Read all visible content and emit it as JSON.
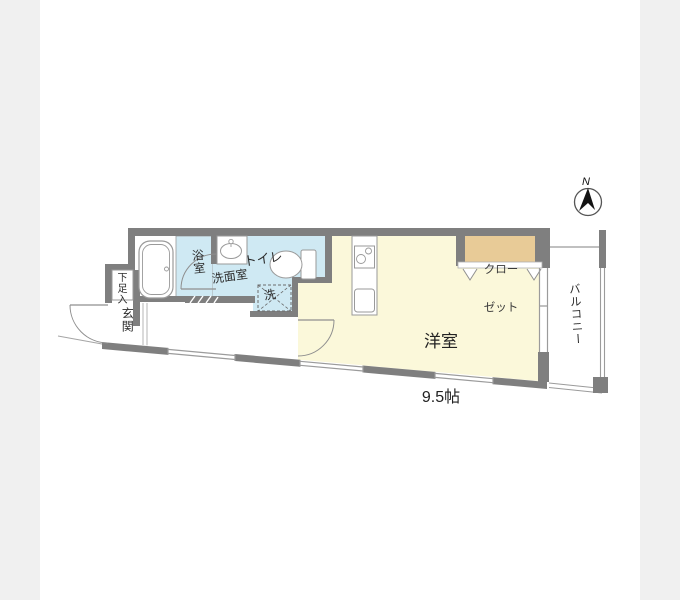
{
  "colors": {
    "wall": "#7f7f7f",
    "wet_area": "#cfe9f3",
    "main_room": "#fbf8da",
    "closet": "#e8cb97",
    "background_strip": "#f0f0f0"
  },
  "floorplan": {
    "compass": {
      "north_label": "N"
    },
    "rooms": {
      "main_room_name": "洋室",
      "main_room_size": "9.5帖",
      "closet_line1": "クロー",
      "closet_line2": "ゼット",
      "balcony": "バルコニー",
      "toilet": "トイレ",
      "washroom": "洗面室",
      "bathroom": "浴室",
      "laundry": "洗",
      "entrance": "玄関",
      "shoe_cabinet": "下足入"
    }
  }
}
